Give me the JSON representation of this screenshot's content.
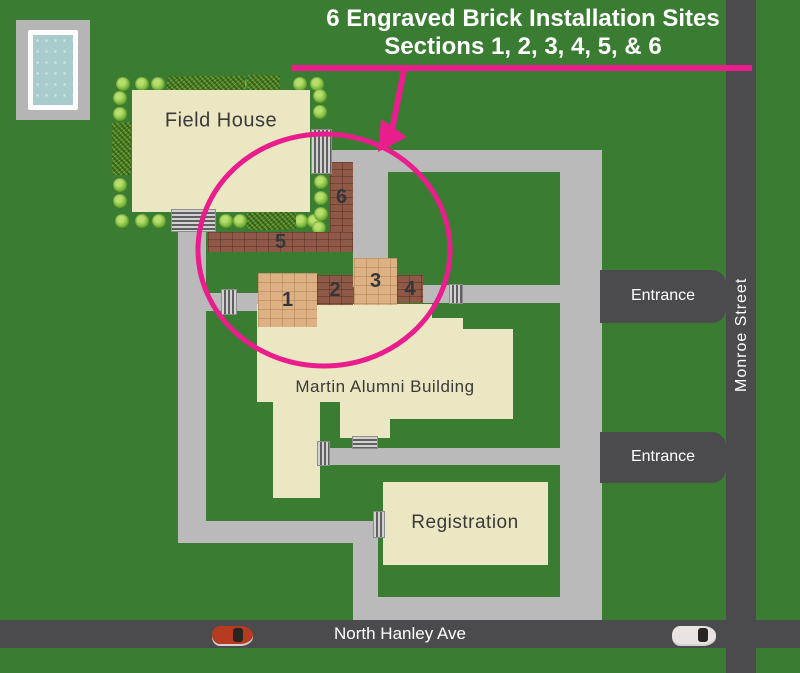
{
  "title": {
    "line1": "6 Engraved Brick Installation Sites",
    "line2": "Sections 1, 2, 3, 4, 5, & 6"
  },
  "buildings": {
    "field_house": "Field House",
    "martin_alumni": "Martin Alumni Building",
    "registration": "Registration"
  },
  "sections": [
    {
      "num": "1",
      "shade": "light"
    },
    {
      "num": "2",
      "shade": "dark"
    },
    {
      "num": "3",
      "shade": "light"
    },
    {
      "num": "4",
      "shade": "dark"
    },
    {
      "num": "5",
      "shade": "dark"
    },
    {
      "num": "6",
      "shade": "dark"
    }
  ],
  "labels": {
    "entrance_north": "Entrance",
    "entrance_south": "Entrance",
    "monroe_street": "Monroe Street",
    "north_hanley": "North Hanley Ave"
  },
  "colors": {
    "grass": "#3a7c31",
    "road_light": "#b9bab9",
    "street_dark": "#4b4b4d",
    "building_cream": "#ece7c3",
    "brick_dark": "#8e5a47",
    "brick_light": "#ddb183",
    "accent_pink": "#ea1d8d",
    "pool_water": "#a8cccb",
    "label_dark": "#3a3a3a",
    "label_white": "#ffffff"
  }
}
